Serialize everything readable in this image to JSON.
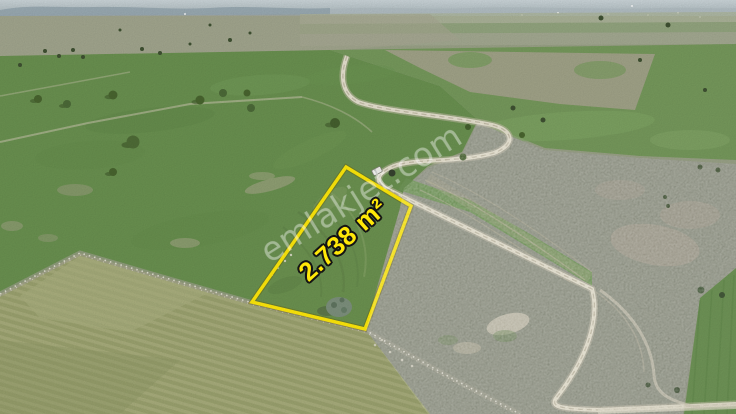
{
  "photo": {
    "watermark_text": "emlakjet.com",
    "parcel": {
      "area_label": "2.738 m²",
      "outline_color": "#ffe90a",
      "label_fill_color": "#ffe808",
      "label_outline_color": "#141414"
    },
    "watermark_color": "#ffffff",
    "objects": {
      "road": "winding dirt road",
      "vehicle": "white van on dirt road",
      "parcel_tree": "tree on parcel boundary",
      "plowed_field": "plowed olive field lower left",
      "horizon": "hazy hills"
    }
  }
}
